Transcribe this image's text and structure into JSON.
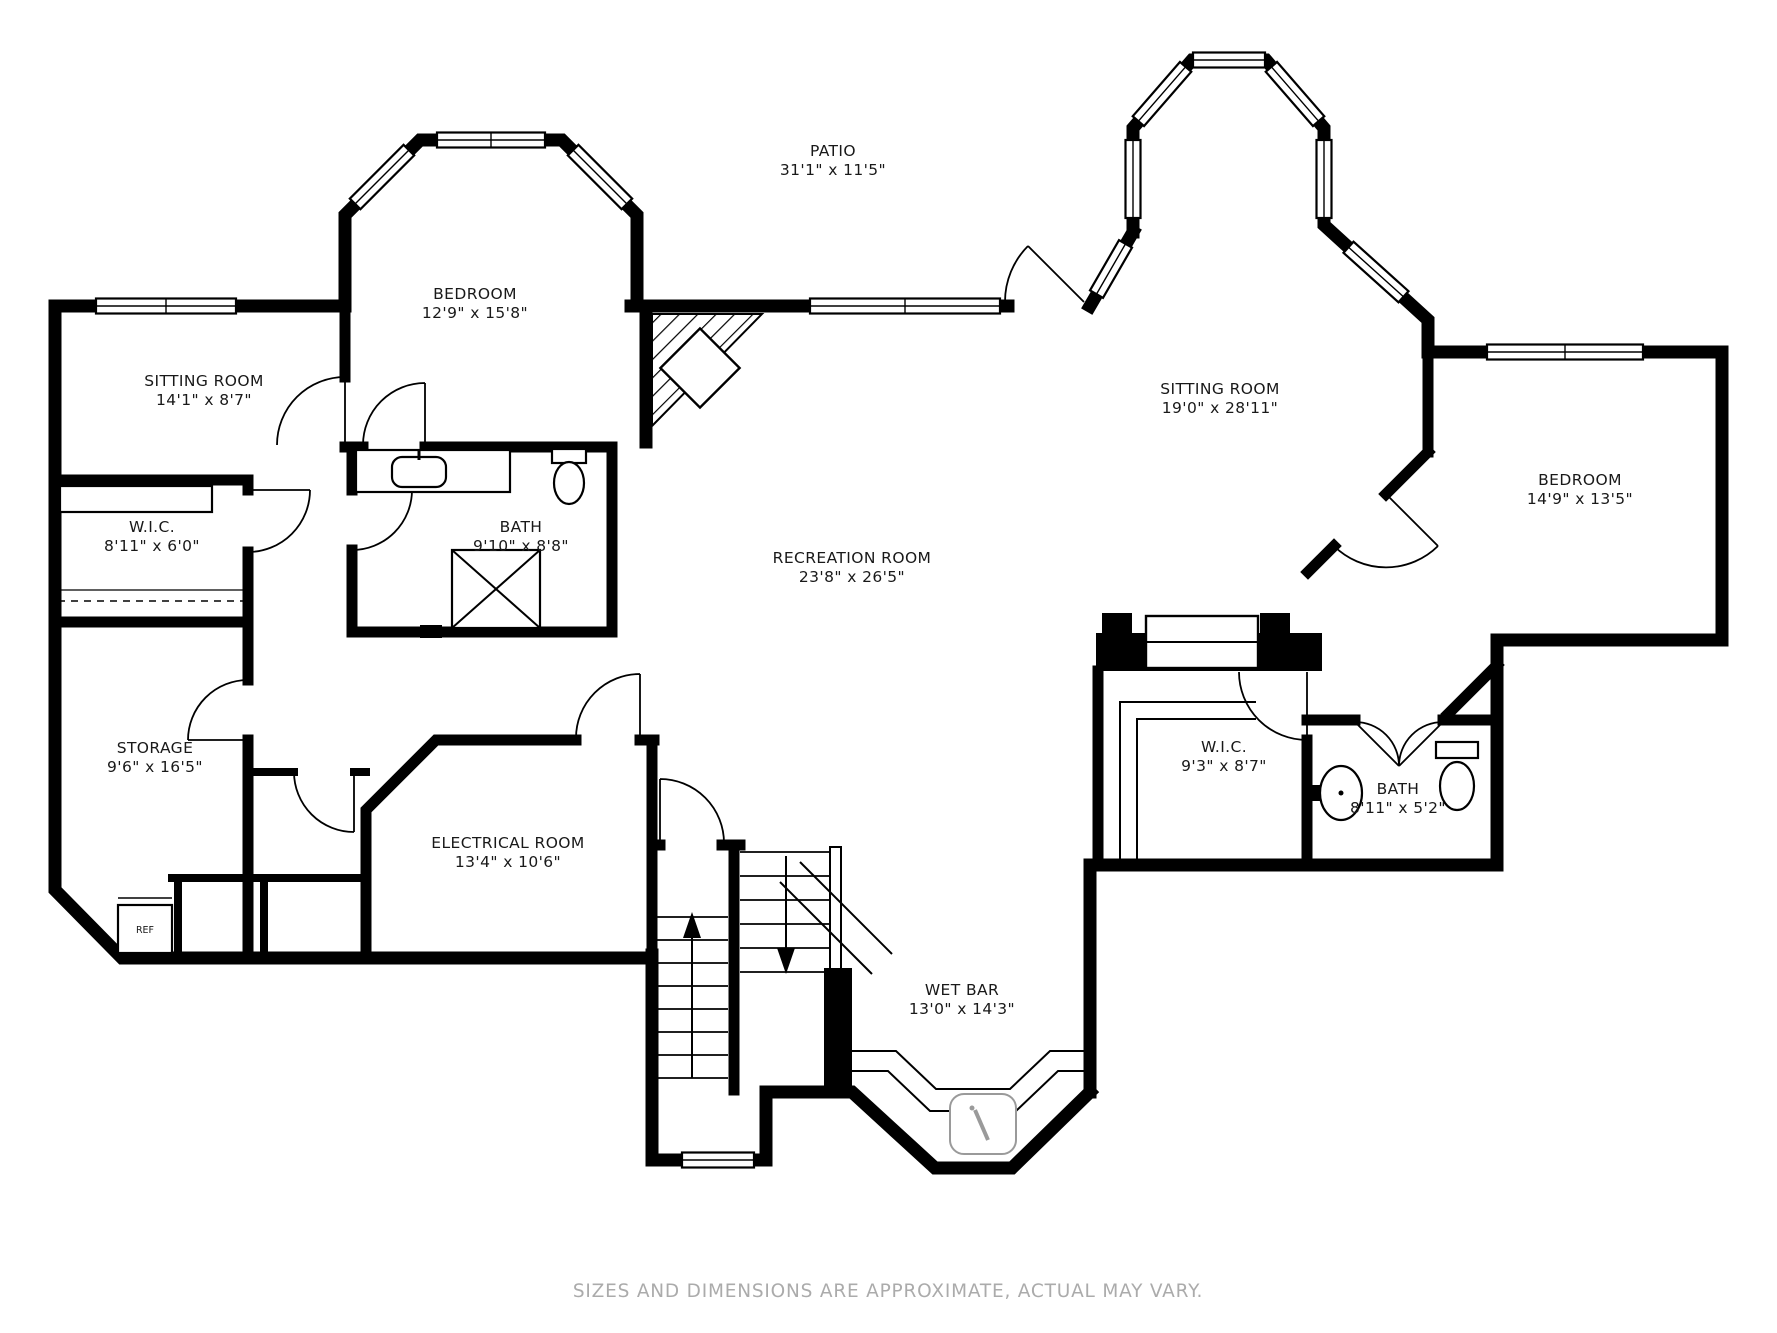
{
  "rooms": [
    {
      "key": "patio",
      "name": "PATIO",
      "dims": "31'1\" x 11'5\""
    },
    {
      "key": "bedroom-left",
      "name": "BEDROOM",
      "dims": "12'9\" x 15'8\""
    },
    {
      "key": "sitting-room-left",
      "name": "SITTING ROOM",
      "dims": "14'1\" x 8'7\""
    },
    {
      "key": "wic-left",
      "name": "W.I.C.",
      "dims": "8'11\" x 6'0\""
    },
    {
      "key": "bath-left",
      "name": "BATH",
      "dims": "9'10\" x 8'8\""
    },
    {
      "key": "recreation-room",
      "name": "RECREATION ROOM",
      "dims": "23'8\" x 26'5\""
    },
    {
      "key": "sitting-room-right",
      "name": "SITTING ROOM",
      "dims": "19'0\" x 28'11\""
    },
    {
      "key": "bedroom-right",
      "name": "BEDROOM",
      "dims": "14'9\" x 13'5\""
    },
    {
      "key": "storage",
      "name": "STORAGE",
      "dims": "9'6\" x 16'5\""
    },
    {
      "key": "electrical-room",
      "name": "ELECTRICAL ROOM",
      "dims": "13'4\" x 10'6\""
    },
    {
      "key": "wic-right",
      "name": "W.I.C.",
      "dims": "9'3\" x 8'7\""
    },
    {
      "key": "bath-right",
      "name": "BATH",
      "dims": "8'11\" x 5'2\""
    },
    {
      "key": "wet-bar",
      "name": "WET BAR",
      "dims": "13'0\" x 14'3\""
    }
  ],
  "labels": {
    "refrigerator": "REF"
  },
  "footer": {
    "disclaimer": "SIZES AND DIMENSIONS ARE APPROXIMATE, ACTUAL MAY VARY."
  },
  "colors": {
    "walls": "#000000",
    "background": "#ffffff",
    "text": "#191919",
    "footer_text": "#ababab"
  }
}
